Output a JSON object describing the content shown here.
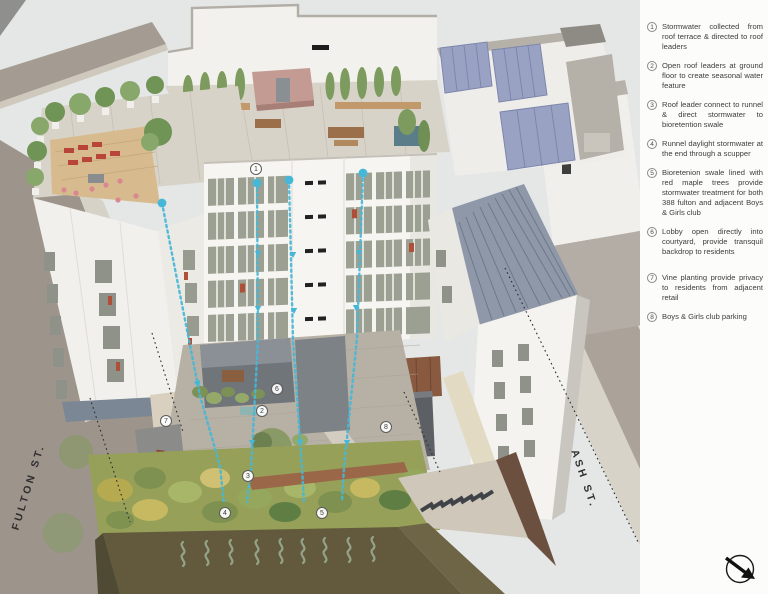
{
  "title": "Stormwater diagram — 388 Fulton axonometric rendering",
  "streets": {
    "fulton": "FULTON ST.",
    "ash": "ASH ST."
  },
  "markers": [
    {
      "num": "1"
    },
    {
      "num": "2"
    },
    {
      "num": "3"
    },
    {
      "num": "4"
    },
    {
      "num": "5"
    },
    {
      "num": "6"
    },
    {
      "num": "7"
    },
    {
      "num": "8"
    }
  ],
  "legend": {
    "items": [
      {
        "num": "1",
        "text": "Stormwater collected from roof terrace & directed to roof leaders"
      },
      {
        "num": "2",
        "text": "Open roof leaders at ground floor to create seasonal water feature"
      },
      {
        "num": "3",
        "text": "Roof leader connect to runnel & direct stormwater to bioretention swale"
      },
      {
        "num": "4",
        "text": "Runnel daylight stormwater at the end through a scupper"
      },
      {
        "num": "5",
        "text": "Bioretenion swale lined with red maple trees provide stormwater treatment for both 388 fulton and adjacent Boys & Girls club"
      },
      {
        "num": "6",
        "text": "Lobby open directly into courtyard, provide transquil backdrop to residents"
      },
      {
        "num": "7",
        "text": "Vine planting provide privacy to residents from adjacent retail"
      },
      {
        "num": "8",
        "text": "Boys & Girls club parking"
      }
    ]
  },
  "icons": {
    "compass": "north-arrow"
  },
  "colors": {
    "flow_line": "#45b8d8",
    "legend_text": "#3d3d3d",
    "soil": "#63593d",
    "solar_panel": "#9aa2c4",
    "slate_roof": "#8f98a8"
  }
}
